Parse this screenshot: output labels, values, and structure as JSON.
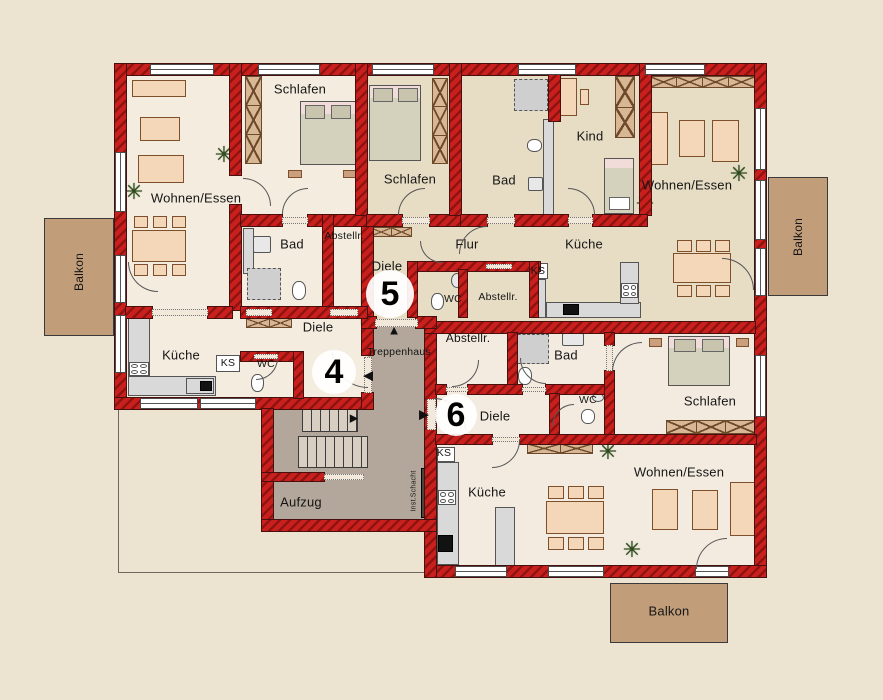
{
  "units": [
    {
      "number": "4"
    },
    {
      "number": "5"
    },
    {
      "number": "6"
    }
  ],
  "rooms": {
    "a4_wohnen": "Wohnen/Essen",
    "a4_schlafen": "Schlafen",
    "a4_bad": "Bad",
    "a4_abstell": "Abstellr.",
    "a4_diele": "Diele",
    "a4_kueche": "Küche",
    "a4_ks": "KS",
    "a4_wc": "WC",
    "a5_schlafen": "Schlafen",
    "a5_bad": "Bad",
    "a5_kind": "Kind",
    "a5_flur": "Flur",
    "a5_kueche": "Küche",
    "a5_diele": "Diele",
    "a5_abstell": "Abstellr.",
    "a5_wc": "WC",
    "a5_ks": "KS",
    "a5_wohnen": "Wohnen/Essen",
    "a6_abstell": "Abstellr.",
    "a6_bad": "Bad",
    "a6_diele": "Diele",
    "a6_wc": "WC",
    "a6_ks": "KS",
    "a6_kueche": "Küche",
    "a6_schlafen": "Schlafen",
    "a6_wohnen": "Wohnen/Essen"
  },
  "core": {
    "treppenhaus": "Treppenhaus",
    "aufzug": "Aufzug",
    "inst_schacht": "Inst.Schacht"
  },
  "balconies": {
    "left": "Balkon",
    "right": "Balkon",
    "bottom": "Balkon"
  },
  "icons": {
    "plant": "✳",
    "arrow_up": "▲",
    "arrow_left": "◀",
    "arrow_right": "▶"
  },
  "colors": {
    "background": "#EDE3D1",
    "wall_red": "#C9201D",
    "wall_red_dark": "#8F1310",
    "floor_light": "#F4ECDF",
    "floor_tan": "#E7DDC5",
    "core_floor": "#B2A79A",
    "balcony": "#C19E79",
    "furniture_peach": "#F4D7B8",
    "plant_green": "#2C4A1C"
  }
}
